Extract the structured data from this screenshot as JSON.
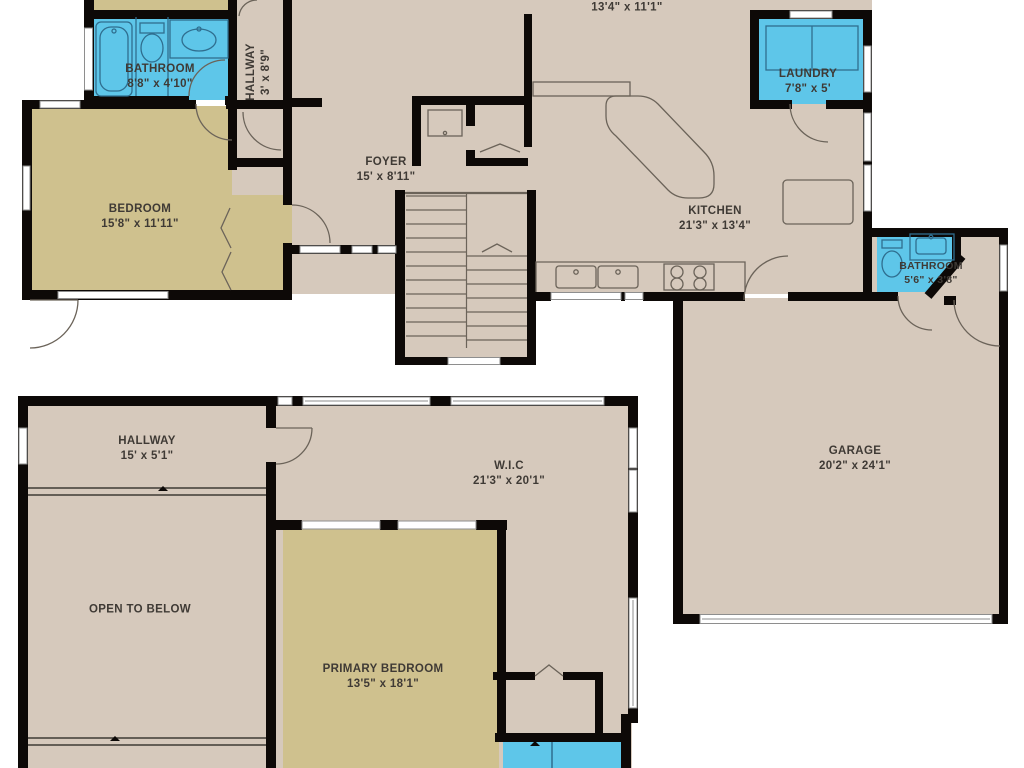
{
  "palette": {
    "wall": "#0d0907",
    "floor": "#d6c9bc",
    "bedroom_floor": "#cfc18e",
    "wet_room_floor": "#5ec6e9",
    "fixture_line_tan": "#6b6359",
    "fixture_line_wet": "#2f6e8f",
    "window_fill": "#ffffff",
    "window_frame": "#8e8e8e",
    "label_text": "#3f3a35",
    "background": "#ffffff"
  },
  "floor1": {
    "rooms": {
      "dining_partial": {
        "name": "",
        "dims": "13'4\" x 11'1\""
      },
      "bathroom_upper": {
        "name": "BATHROOM",
        "dims": "8'8\" x 4'10\""
      },
      "hallway_upper": {
        "name": "HALLWAY",
        "dims": "3' x 8'9\""
      },
      "bedroom": {
        "name": "BEDROOM",
        "dims": "15'8\" x 11'11\""
      },
      "foyer": {
        "name": "FOYER",
        "dims": "15' x 8'11\""
      },
      "kitchen": {
        "name": "KITCHEN",
        "dims": "21'3\" x 13'4\""
      },
      "laundry": {
        "name": "LAUNDRY",
        "dims": "7'8\" x 5'"
      },
      "bathroom_main": {
        "name": "BATHROOM",
        "dims": "5'6\" x 3'8\""
      },
      "garage": {
        "name": "GARAGE",
        "dims": "20'2\" x 24'1\""
      }
    }
  },
  "floor2": {
    "rooms": {
      "hallway": {
        "name": "HALLWAY",
        "dims": "15' x 5'1\""
      },
      "open_to_below": {
        "name": "OPEN TO BELOW",
        "dims": ""
      },
      "wic": {
        "name": "W.I.C",
        "dims": "21'3\" x 20'1\""
      },
      "primary_bedroom": {
        "name": "PRIMARY BEDROOM",
        "dims": "13'5\" x 18'1\""
      }
    }
  }
}
